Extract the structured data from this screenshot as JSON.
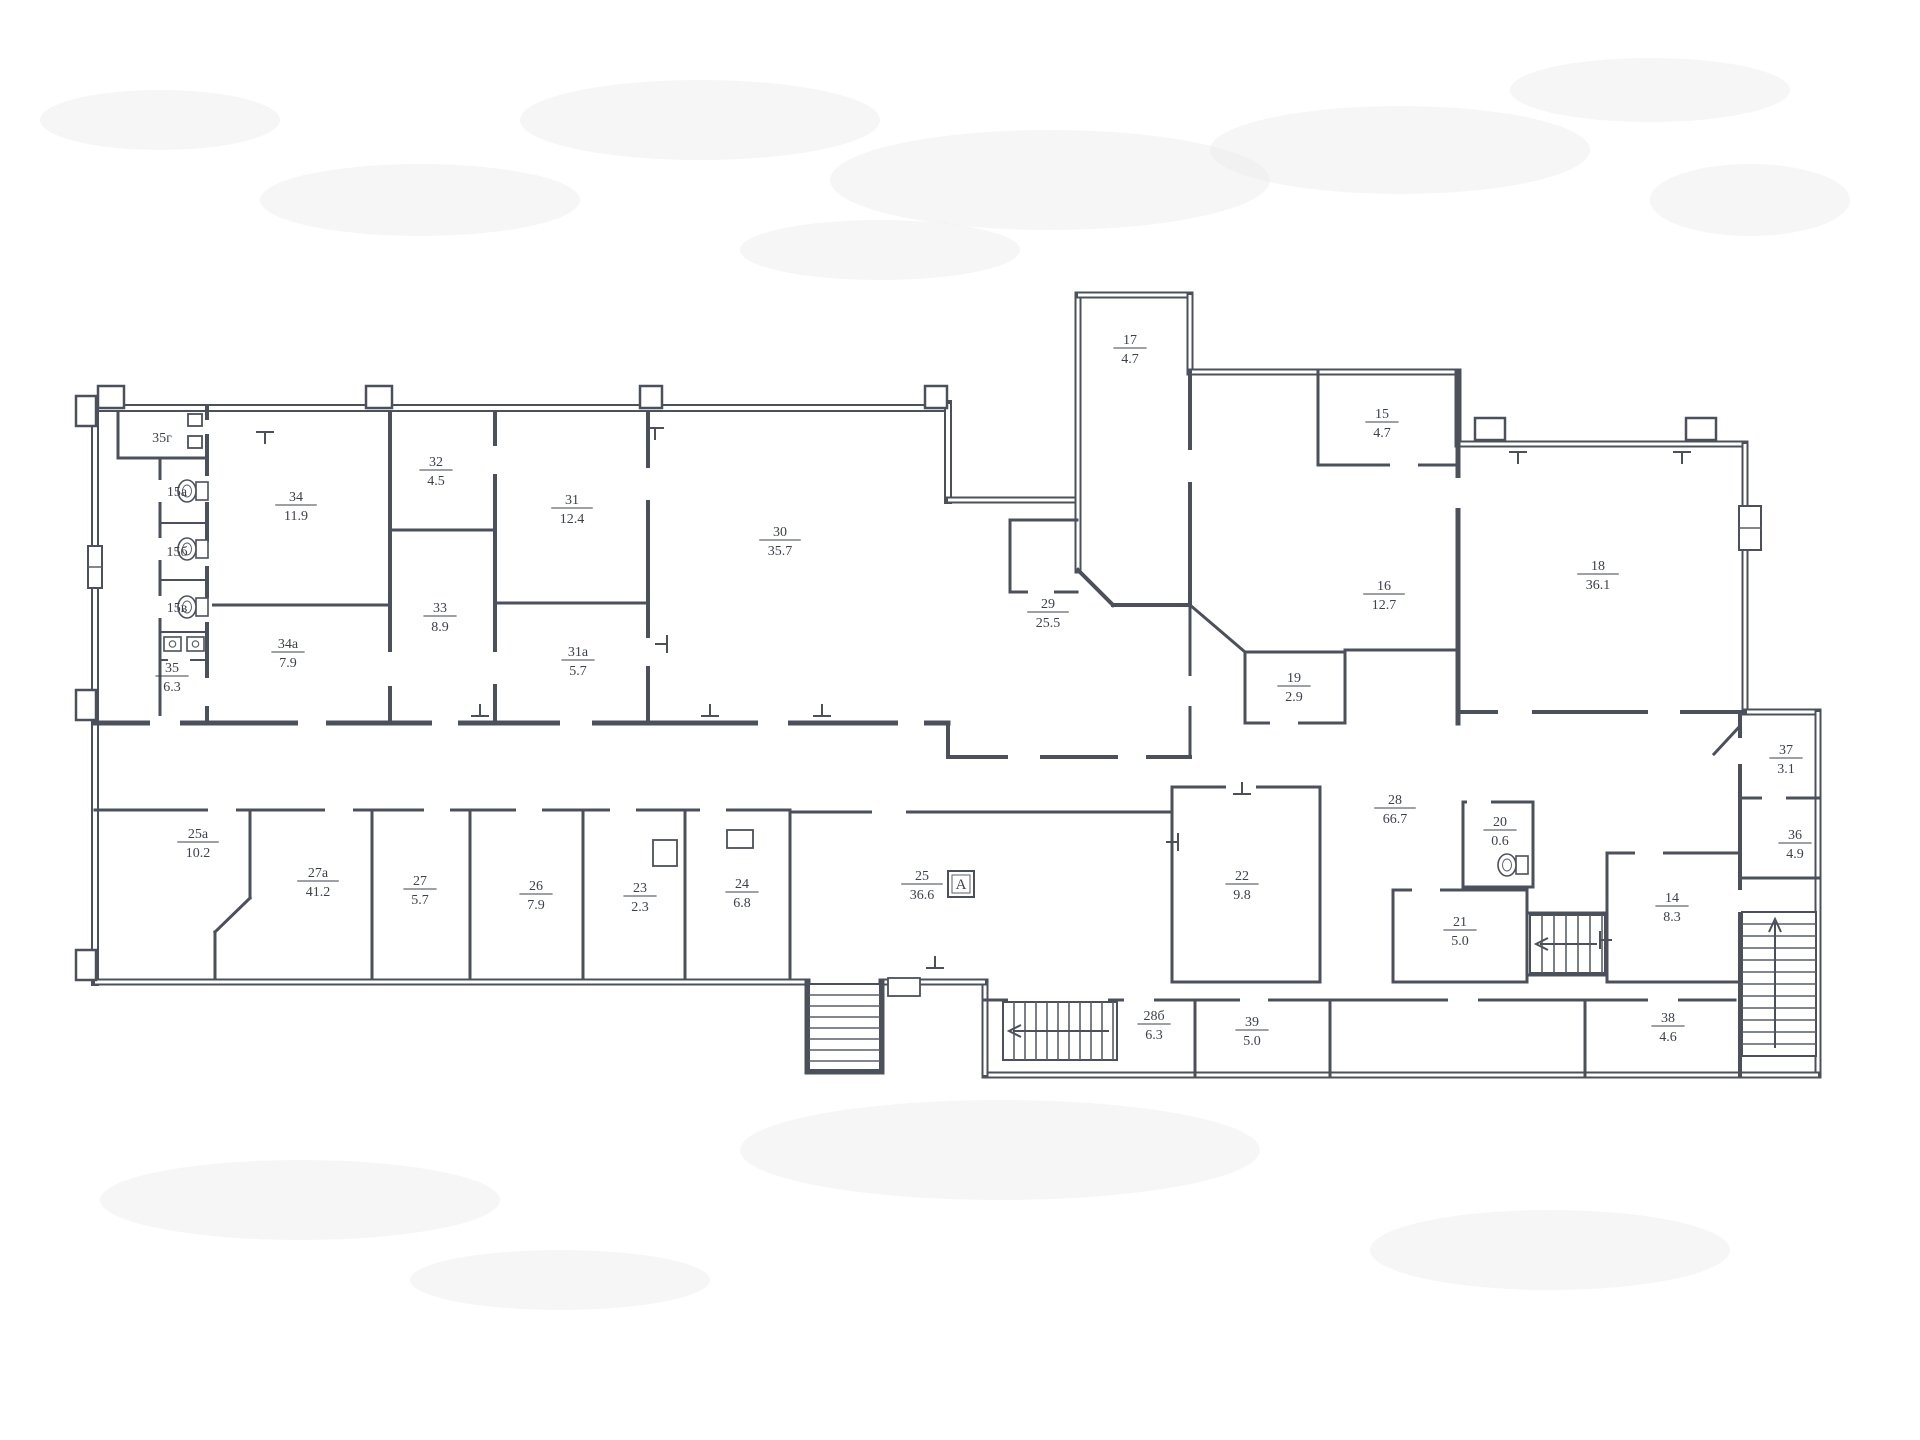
{
  "document": {
    "kind": "scanned architectural floor plan (BTI style)",
    "canvas": {
      "w": 1920,
      "h": 1440
    },
    "palette": {
      "paper": "#ffffff",
      "ink": "#4b505a",
      "ink_light": "#5a5f69",
      "label": "#3c414c",
      "smudge": "#ececea"
    }
  },
  "rooms": [
    {
      "num": "35г",
      "area": null,
      "x": 162,
      "y": 437
    },
    {
      "num": "15а",
      "area": null,
      "x": 177,
      "y": 491
    },
    {
      "num": "15б",
      "area": null,
      "x": 177,
      "y": 551
    },
    {
      "num": "15в",
      "area": null,
      "x": 177,
      "y": 607
    },
    {
      "num": "35",
      "area": "6.3",
      "x": 172,
      "y": 676
    },
    {
      "num": "34",
      "area": "11.9",
      "x": 296,
      "y": 505
    },
    {
      "num": "34а",
      "area": "7.9",
      "x": 288,
      "y": 652
    },
    {
      "num": "32",
      "area": "4.5",
      "x": 436,
      "y": 470
    },
    {
      "num": "33",
      "area": "8.9",
      "x": 440,
      "y": 616
    },
    {
      "num": "31",
      "area": "12.4",
      "x": 572,
      "y": 508
    },
    {
      "num": "31а",
      "area": "5.7",
      "x": 578,
      "y": 660
    },
    {
      "num": "30",
      "area": "35.7",
      "x": 780,
      "y": 540
    },
    {
      "num": "29",
      "area": "25.5",
      "x": 1048,
      "y": 612
    },
    {
      "num": "17",
      "area": "4.7",
      "x": 1130,
      "y": 348
    },
    {
      "num": "15",
      "area": "4.7",
      "x": 1382,
      "y": 422
    },
    {
      "num": "16",
      "area": "12.7",
      "x": 1384,
      "y": 594
    },
    {
      "num": "19",
      "area": "2.9",
      "x": 1294,
      "y": 686
    },
    {
      "num": "18",
      "area": "36.1",
      "x": 1598,
      "y": 574
    },
    {
      "num": "28",
      "area": "66.7",
      "x": 1395,
      "y": 808
    },
    {
      "num": "20",
      "area": "0.6",
      "x": 1500,
      "y": 830
    },
    {
      "num": "22",
      "area": "9.8",
      "x": 1242,
      "y": 884
    },
    {
      "num": "21",
      "area": "5.0",
      "x": 1460,
      "y": 930
    },
    {
      "num": "14",
      "area": "8.3",
      "x": 1672,
      "y": 906
    },
    {
      "num": "37",
      "area": "3.1",
      "x": 1786,
      "y": 758
    },
    {
      "num": "36",
      "area": "4.9",
      "x": 1795,
      "y": 843
    },
    {
      "num": "38",
      "area": "4.6",
      "x": 1668,
      "y": 1026
    },
    {
      "num": "28б",
      "area": "6.3",
      "x": 1154,
      "y": 1024
    },
    {
      "num": "39",
      "area": "5.0",
      "x": 1252,
      "y": 1030
    },
    {
      "num": "25",
      "area": "36.6",
      "x": 922,
      "y": 884
    },
    {
      "num": "24",
      "area": "6.8",
      "x": 742,
      "y": 892
    },
    {
      "num": "23",
      "area": "2.3",
      "x": 640,
      "y": 896
    },
    {
      "num": "26",
      "area": "7.9",
      "x": 536,
      "y": 894
    },
    {
      "num": "27",
      "area": "5.7",
      "x": 420,
      "y": 889
    },
    {
      "num": "27а",
      "area": "41.2",
      "x": 318,
      "y": 881
    },
    {
      "num": "25а",
      "area": "10.2",
      "x": 198,
      "y": 842
    }
  ],
  "marker_box": {
    "x": 948,
    "y": 871,
    "size": 26,
    "label": "А"
  },
  "walls": [
    [
      95,
      408,
      948,
      408,
      8
    ],
    [
      95,
      404,
      95,
      982,
      8
    ],
    [
      948,
      404,
      948,
      500,
      8
    ],
    [
      948,
      500,
      1078,
      500,
      7
    ],
    [
      1078,
      295,
      1078,
      570,
      7
    ],
    [
      1078,
      295,
      1190,
      295,
      7
    ],
    [
      1190,
      295,
      1190,
      372,
      7
    ],
    [
      1190,
      372,
      1458,
      372,
      7
    ],
    [
      1458,
      372,
      1458,
      444,
      7
    ],
    [
      1458,
      444,
      1745,
      444,
      7
    ],
    [
      1745,
      444,
      1745,
      712,
      7
    ],
    [
      1745,
      712,
      1818,
      712,
      7
    ],
    [
      1818,
      712,
      1818,
      1075,
      7
    ],
    [
      985,
      1075,
      1818,
      1075,
      7
    ],
    [
      985,
      982,
      985,
      1075,
      7
    ],
    [
      882,
      982,
      985,
      982,
      7
    ],
    [
      95,
      982,
      807,
      982,
      7
    ],
    [
      807,
      982,
      807,
      1072,
      5
    ],
    [
      807,
      1072,
      882,
      1072,
      5
    ],
    [
      882,
      982,
      882,
      1072,
      5
    ],
    [
      95,
      723,
      948,
      723,
      5
    ],
    [
      948,
      723,
      948,
      757,
      4
    ],
    [
      948,
      757,
      1190,
      757,
      4
    ],
    [
      118,
      412,
      118,
      458,
      3
    ],
    [
      118,
      458,
      207,
      458,
      3
    ],
    [
      207,
      408,
      207,
      723,
      4
    ],
    [
      160,
      458,
      160,
      723,
      3
    ],
    [
      160,
      523,
      207,
      523,
      2
    ],
    [
      160,
      580,
      207,
      580,
      2
    ],
    [
      160,
      632,
      207,
      632,
      2
    ],
    [
      160,
      660,
      207,
      660,
      2
    ],
    [
      207,
      605,
      390,
      605,
      3
    ],
    [
      390,
      412,
      390,
      723,
      4
    ],
    [
      390,
      530,
      495,
      530,
      3
    ],
    [
      495,
      412,
      495,
      723,
      4
    ],
    [
      495,
      603,
      648,
      603,
      3
    ],
    [
      648,
      412,
      648,
      723,
      4
    ],
    [
      1010,
      520,
      1077,
      520,
      3
    ],
    [
      1010,
      520,
      1010,
      592,
      3
    ],
    [
      1010,
      592,
      1077,
      592,
      3
    ],
    [
      1078,
      570,
      1113,
      605,
      4
    ],
    [
      1113,
      605,
      1190,
      605,
      4
    ],
    [
      1190,
      372,
      1190,
      605,
      4
    ],
    [
      1190,
      605,
      1190,
      757,
      3
    ],
    [
      1318,
      372,
      1318,
      465,
      3
    ],
    [
      1318,
      465,
      1458,
      465,
      3
    ],
    [
      1190,
      605,
      1245,
      652,
      3
    ],
    [
      1245,
      652,
      1345,
      652,
      3
    ],
    [
      1245,
      652,
      1245,
      723,
      3
    ],
    [
      1345,
      652,
      1345,
      723,
      3
    ],
    [
      1245,
      723,
      1345,
      723,
      3
    ],
    [
      1345,
      650,
      1458,
      650,
      3
    ],
    [
      1458,
      372,
      1458,
      723,
      5
    ],
    [
      1458,
      712,
      1745,
      712,
      4
    ],
    [
      1740,
      712,
      1740,
      1075,
      4
    ],
    [
      1742,
      798,
      1818,
      798,
      3
    ],
    [
      1742,
      878,
      1818,
      878,
      3
    ],
    [
      1740,
      726,
      1714,
      754,
      3
    ],
    [
      1607,
      853,
      1740,
      853,
      3
    ],
    [
      1607,
      853,
      1607,
      982,
      3
    ],
    [
      1607,
      982,
      1740,
      982,
      3
    ],
    [
      1527,
      913,
      1607,
      913,
      3
    ],
    [
      1527,
      913,
      1527,
      975,
      3
    ],
    [
      1527,
      975,
      1607,
      975,
      3
    ],
    [
      1607,
      913,
      1607,
      975,
      3
    ],
    [
      1393,
      890,
      1527,
      890,
      3
    ],
    [
      1393,
      890,
      1393,
      982,
      3
    ],
    [
      1393,
      982,
      1527,
      982,
      3
    ],
    [
      1527,
      890,
      1527,
      982,
      3
    ],
    [
      1463,
      802,
      1533,
      802,
      3
    ],
    [
      1463,
      802,
      1463,
      887,
      3
    ],
    [
      1463,
      887,
      1533,
      887,
      3
    ],
    [
      1533,
      802,
      1533,
      887,
      3
    ],
    [
      1172,
      787,
      1320,
      787,
      3
    ],
    [
      1320,
      787,
      1320,
      982,
      3
    ],
    [
      1172,
      982,
      1320,
      982,
      3
    ],
    [
      1172,
      787,
      1172,
      982,
      3
    ],
    [
      790,
      812,
      1172,
      812,
      3
    ],
    [
      790,
      812,
      790,
      978,
      3
    ],
    [
      95,
      810,
      790,
      810,
      3
    ],
    [
      250,
      810,
      250,
      898,
      3
    ],
    [
      250,
      898,
      215,
      932,
      3
    ],
    [
      215,
      932,
      215,
      978,
      3
    ],
    [
      372,
      810,
      372,
      978,
      3
    ],
    [
      470,
      810,
      470,
      978,
      3
    ],
    [
      583,
      810,
      583,
      978,
      3
    ],
    [
      685,
      810,
      685,
      978,
      3
    ],
    [
      985,
      1000,
      1735,
      1000,
      3
    ],
    [
      1195,
      1000,
      1195,
      1075,
      3
    ],
    [
      1330,
      1000,
      1330,
      1075,
      3
    ],
    [
      1585,
      1000,
      1585,
      1075,
      3
    ]
  ],
  "door_gaps": [
    [
      150,
      716,
      30,
      14
    ],
    [
      298,
      716,
      28,
      14
    ],
    [
      432,
      716,
      26,
      14
    ],
    [
      560,
      716,
      32,
      14
    ],
    [
      758,
      716,
      30,
      14
    ],
    [
      898,
      716,
      26,
      14
    ],
    [
      1008,
      750,
      32,
      14
    ],
    [
      1118,
      750,
      28,
      14
    ],
    [
      202,
      476,
      10,
      26
    ],
    [
      202,
      542,
      10,
      24
    ],
    [
      202,
      598,
      10,
      24
    ],
    [
      202,
      678,
      10,
      28
    ],
    [
      156,
      480,
      8,
      22
    ],
    [
      156,
      538,
      8,
      22
    ],
    [
      156,
      596,
      8,
      22
    ],
    [
      168,
      654,
      22,
      10
    ],
    [
      202,
      420,
      10,
      14
    ],
    [
      385,
      652,
      10,
      34
    ],
    [
      490,
      446,
      10,
      28
    ],
    [
      490,
      652,
      10,
      32
    ],
    [
      643,
      468,
      10,
      32
    ],
    [
      643,
      638,
      10,
      28
    ],
    [
      1185,
      676,
      10,
      30
    ],
    [
      1185,
      450,
      10,
      32
    ],
    [
      1390,
      458,
      28,
      14
    ],
    [
      1453,
      478,
      10,
      30
    ],
    [
      1498,
      705,
      34,
      14
    ],
    [
      1648,
      705,
      32,
      14
    ],
    [
      1735,
      738,
      10,
      26
    ],
    [
      1735,
      890,
      10,
      22
    ],
    [
      1762,
      791,
      24,
      14
    ],
    [
      208,
      803,
      28,
      14
    ],
    [
      325,
      803,
      28,
      14
    ],
    [
      424,
      803,
      26,
      14
    ],
    [
      516,
      803,
      26,
      14
    ],
    [
      610,
      803,
      26,
      14
    ],
    [
      700,
      803,
      26,
      14
    ],
    [
      872,
      805,
      34,
      14
    ],
    [
      1226,
      780,
      30,
      14
    ],
    [
      1467,
      795,
      24,
      14
    ],
    [
      1412,
      883,
      28,
      14
    ],
    [
      1008,
      994,
      100,
      13
    ],
    [
      1124,
      993,
      30,
      14
    ],
    [
      1240,
      993,
      28,
      14
    ],
    [
      1448,
      993,
      30,
      14
    ],
    [
      1648,
      993,
      30,
      14
    ],
    [
      1635,
      846,
      28,
      14
    ],
    [
      1028,
      585,
      26,
      14
    ],
    [
      1270,
      716,
      28,
      14
    ]
  ],
  "pilasters": [
    [
      98,
      386,
      26,
      22
    ],
    [
      366,
      386,
      26,
      22
    ],
    [
      640,
      386,
      22,
      22
    ],
    [
      925,
      386,
      22,
      22
    ],
    [
      1475,
      418,
      30,
      22
    ],
    [
      1686,
      418,
      30,
      22
    ],
    [
      76,
      396,
      20,
      30
    ],
    [
      76,
      690,
      20,
      30
    ],
    [
      76,
      950,
      20,
      30
    ]
  ],
  "windows": [
    {
      "x": 88,
      "y": 546,
      "w": 14,
      "h": 42
    },
    {
      "x": 1739,
      "y": 506,
      "w": 22,
      "h": 44
    }
  ],
  "stairs": [
    {
      "x": 1003,
      "y": 1002,
      "w": 114,
      "h": 58,
      "dir": "v",
      "step": 11,
      "arrow": "left"
    },
    {
      "x": 1742,
      "y": 912,
      "w": 74,
      "h": 144,
      "dir": "h",
      "step": 12,
      "arrow": "up"
    },
    {
      "x": 1530,
      "y": 915,
      "w": 75,
      "h": 58,
      "dir": "v",
      "step": 12,
      "arrow": "left"
    },
    {
      "x": 809,
      "y": 984,
      "w": 71,
      "h": 86,
      "dir": "h",
      "step": 11,
      "arrow": null
    }
  ],
  "radiators": [
    [
      265,
      432,
      0
    ],
    [
      655,
      428,
      0
    ],
    [
      710,
      716,
      180
    ],
    [
      822,
      716,
      180
    ],
    [
      480,
      716,
      180
    ],
    [
      1518,
      452,
      0
    ],
    [
      1682,
      452,
      0
    ],
    [
      1242,
      794,
      180
    ],
    [
      1178,
      842,
      90
    ],
    [
      1600,
      940,
      270
    ],
    [
      667,
      644,
      90
    ],
    [
      935,
      968,
      180
    ]
  ],
  "fixtures": {
    "toilets": [
      {
        "x": 196,
        "y": 482
      },
      {
        "x": 196,
        "y": 540
      },
      {
        "x": 196,
        "y": 598
      },
      {
        "x": 1516,
        "y": 856
      }
    ],
    "sinks": [
      {
        "x": 164,
        "y": 637
      },
      {
        "x": 187,
        "y": 637
      }
    ],
    "door_boxes": [
      {
        "x": 188,
        "y": 414,
        "w": 14,
        "h": 12
      },
      {
        "x": 188,
        "y": 436,
        "w": 14,
        "h": 12
      },
      {
        "x": 888,
        "y": 978,
        "w": 32,
        "h": 18
      },
      {
        "x": 727,
        "y": 830,
        "w": 26,
        "h": 18
      },
      {
        "x": 653,
        "y": 840,
        "w": 24,
        "h": 26
      }
    ]
  },
  "smudges": [
    [
      700,
      120,
      180,
      40
    ],
    [
      1050,
      180,
      220,
      50
    ],
    [
      420,
      200,
      160,
      36
    ],
    [
      1400,
      150,
      190,
      44
    ],
    [
      880,
      250,
      140,
      30
    ],
    [
      300,
      1200,
      200,
      40
    ],
    [
      1000,
      1150,
      260,
      50
    ],
    [
      1550,
      1250,
      180,
      40
    ],
    [
      160,
      120,
      120,
      30
    ],
    [
      1750,
      200,
      100,
      36
    ],
    [
      1650,
      90,
      140,
      32
    ],
    [
      560,
      1280,
      150,
      30
    ]
  ]
}
